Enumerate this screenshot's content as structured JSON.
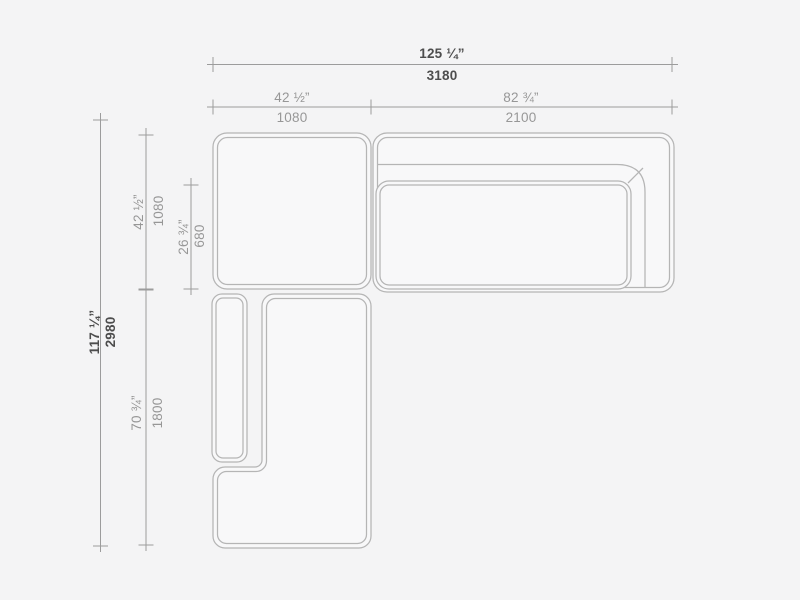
{
  "page": {
    "width": 800,
    "height": 600
  },
  "colors": {
    "background": "#f4f4f5",
    "furniture_fill": "#f8f8f9",
    "furniture_outline": "#b5b5b5",
    "dimension_line": "#9c9c9c",
    "primary_text": "#4d4d4d",
    "secondary_text": "#979797"
  },
  "dimensions": {
    "overall_width": {
      "inches": "125 ¼”",
      "mm": "3180"
    },
    "corner_width": {
      "inches": "42 ½”",
      "mm": "1080"
    },
    "sofa_width": {
      "inches": "82 ¾”",
      "mm": "2100"
    },
    "overall_depth": {
      "inches": "117 ¼”",
      "mm": "2980"
    },
    "corner_depth": {
      "inches": "42 ½”",
      "mm": "1080"
    },
    "seat_depth": {
      "inches": "26 ¾”",
      "mm": "680"
    },
    "chaise_length": {
      "inches": "70 ¾”",
      "mm": "1800"
    }
  }
}
